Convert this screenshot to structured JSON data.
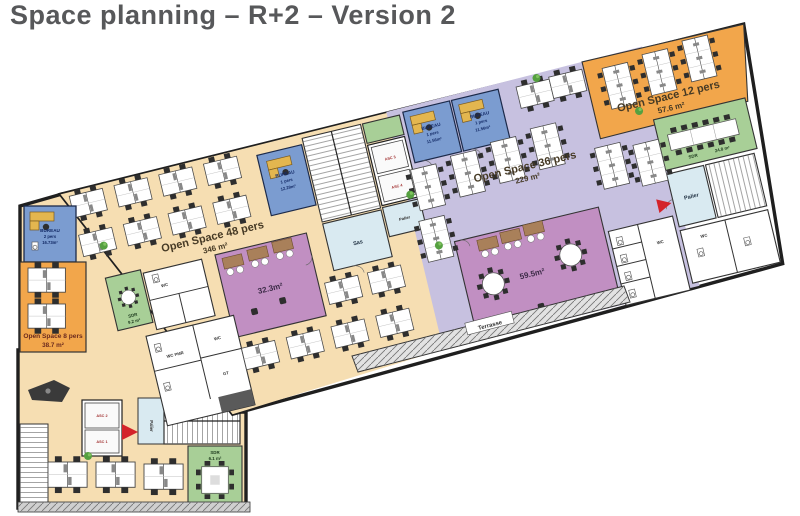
{
  "title": "Space planning – R+2 – Version 2",
  "colors": {
    "floor_beige": "#f6deb2",
    "open_space_orange": "#f2a64b",
    "open_space_lavender": "#c7c1e0",
    "meeting_purple": "#c18fc2",
    "office_blue": "#7b9cd0",
    "meeting_green": "#a8cf97",
    "circulation_blue": "#d9eaf1",
    "wall": "#1f1f1f",
    "marker_red": "#d4232a"
  },
  "plan": {
    "open_spaces": [
      {
        "name": "Open Space 48 pers",
        "area": "346 m²"
      },
      {
        "name": "Open Space 36 pers",
        "area": "229 m²"
      },
      {
        "name": "Open Space 12 pers",
        "area": "57.6 m²"
      },
      {
        "name": "Open Space 8 pers",
        "area": "38.7 m²"
      }
    ],
    "offices": [
      {
        "name": "BUREAU",
        "capacity": "2 pers",
        "area": "16.73m²"
      },
      {
        "name": "BUREAU",
        "capacity": "1 pers",
        "area": "12.29m²"
      },
      {
        "name": "BUREAU",
        "capacity": "1 pers",
        "area": "11.56m²"
      },
      {
        "name": "BUREAU",
        "capacity": "1 pers",
        "area": "11.56m²"
      }
    ],
    "meeting_rooms": [
      {
        "name": "SDR",
        "area": "24.8 m²"
      },
      {
        "name": "SDR",
        "area": "9.2 m²"
      },
      {
        "name": "SDR",
        "area": "6.1 m²"
      },
      {
        "name": "",
        "area": "32.3m²"
      },
      {
        "name": "",
        "area": "59.5m²"
      }
    ],
    "circulation": {
      "sas": "Sas",
      "palier": "Palier",
      "terrasse": "Terrasse"
    },
    "service": {
      "wc": "WC",
      "wc_pmr": "WC PMR",
      "gt": "GT"
    },
    "elevators": [
      "ASC 1",
      "ASC 2",
      "ASC 3",
      "ASC 4"
    ]
  },
  "furniture": {
    "bar": {
      "d4": [
        [
          18,
          16
        ],
        [
          64,
          16
        ],
        [
          110,
          16
        ],
        [
          156,
          16
        ],
        [
          18,
          56
        ],
        [
          64,
          56
        ],
        [
          110,
          56
        ],
        [
          156,
          56
        ],
        [
          246,
          160
        ],
        [
          290,
          160
        ],
        [
          150,
          204
        ],
        [
          196,
          204
        ],
        [
          242,
          204
        ],
        [
          288,
          204
        ],
        [
          478,
          14
        ],
        [
          512,
          12
        ]
      ],
      "d6": [
        [
          356,
          70
        ],
        [
          398,
          66
        ],
        [
          440,
          62
        ],
        [
          482,
          58
        ],
        [
          352,
          122
        ],
        [
          540,
          92
        ],
        [
          578,
          98
        ],
        [
          566,
          16
        ],
        [
          608,
          12
        ],
        [
          650,
          8
        ]
      ],
      "ld": [
        [
          218,
          28
        ],
        [
          368,
          18
        ],
        [
          418,
          18
        ]
      ],
      "rt": [
        [
          410,
          200
        ],
        [
          492,
          190
        ],
        [
          52,
          128,
          0.65
        ]
      ],
      "bo": [
        [
          404,
          154
        ],
        [
          428,
          152
        ],
        [
          452,
          150
        ],
        [
          152,
          112
        ],
        [
          178,
          110
        ],
        [
          204,
          108
        ]
      ],
      "ch": [
        [
          420,
          234
        ],
        [
          448,
          230
        ],
        [
          168,
          168
        ],
        [
          198,
          164
        ]
      ],
      "lt": [
        [
          614,
          96
        ]
      ],
      "pl": [
        [
          350,
          94
        ],
        [
          500,
          10
        ],
        [
          592,
          66
        ],
        [
          40,
          72
        ],
        [
          366,
          150
        ]
      ],
      "wc": [
        [
          540,
          184
        ],
        [
          540,
          202
        ],
        [
          540,
          220
        ],
        [
          540,
          238
        ],
        [
          616,
          214
        ],
        [
          664,
          214
        ],
        [
          80,
          112
        ],
        [
          66,
          180
        ],
        [
          66,
          220
        ]
      ]
    },
    "page": {
      "d4": [
        [
          28,
          268,
          1.1
        ],
        [
          28,
          304,
          1.1
        ],
        [
          48,
          462,
          1.15
        ],
        [
          96,
          462,
          1.15
        ],
        [
          144,
          464,
          1.15
        ]
      ],
      "ld": [
        [
          30,
          212
        ]
      ],
      "st": [
        [
          215,
          480,
          0.95
        ]
      ],
      "rd": [
        [
          28,
          380
        ]
      ],
      "pl": [
        [
          88,
          456
        ]
      ],
      "wc": [
        [
          32,
          242
        ]
      ]
    }
  }
}
